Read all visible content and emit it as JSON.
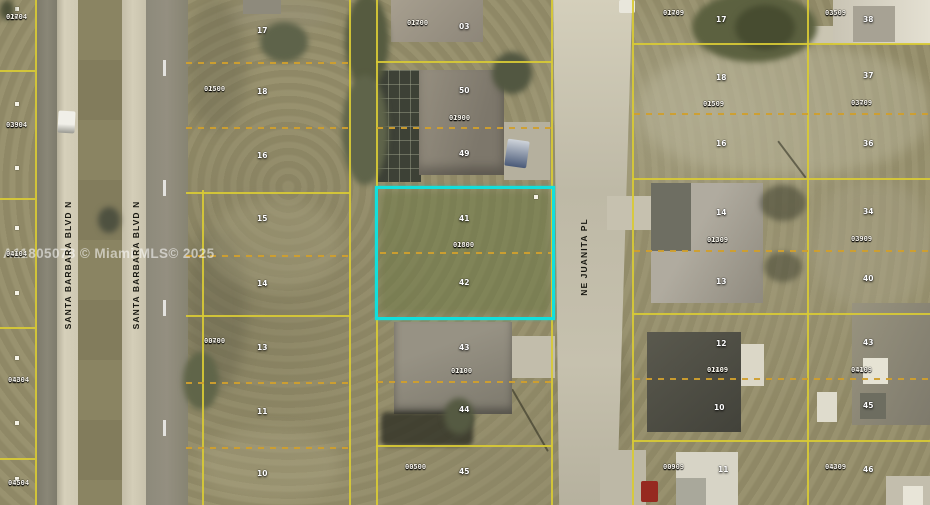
{
  "watermark_text": "A11805078 © Miami MLS© 2025",
  "streets": {
    "santa_barbara": "SANTA BARBARA BLVD N",
    "juanita": "NE JUANITA PL"
  },
  "highlighted_lot": {
    "parcel_label": "02490 0180",
    "lot_numbers_inside": [
      "41",
      "42"
    ],
    "border_color": "#12dfdc"
  },
  "colors": {
    "boundary_solid_yellow": "#d8ca35",
    "boundary_dashed_orange": "#cf9f2e",
    "highlight_cyan": "#12dfdc"
  },
  "parcel_labels": [
    {
      "block": "02694",
      "lot": "0170",
      "x": 6,
      "y": 14
    },
    {
      "block": "02694",
      "lot": "0390",
      "x": 6,
      "y": 122
    },
    {
      "block": "02694",
      "lot": "0410",
      "x": 6,
      "y": 251
    },
    {
      "block": "02694",
      "lot": "0430",
      "x": 8,
      "y": 377
    },
    {
      "block": "02694",
      "lot": "0450",
      "x": 8,
      "y": 480
    },
    {
      "block": "02490",
      "lot": "0150",
      "x": 204,
      "y": 86
    },
    {
      "block": "02490",
      "lot": "0070",
      "x": 204,
      "y": 338
    },
    {
      "block": "02490",
      "lot": "0170",
      "x": 407,
      "y": 20
    },
    {
      "block": "02490",
      "lot": "0190",
      "x": 449,
      "y": 115
    },
    {
      "block": "02490",
      "lot": "0180",
      "x": 453,
      "y": 242
    },
    {
      "block": "02490",
      "lot": "0110",
      "x": 451,
      "y": 368
    },
    {
      "block": "02490",
      "lot": "0050",
      "x": 405,
      "y": 464
    },
    {
      "block": "02489",
      "lot": "0170",
      "x": 663,
      "y": 10
    },
    {
      "block": "02489",
      "lot": "0150",
      "x": 703,
      "y": 101
    },
    {
      "block": "02489",
      "lot": "0130",
      "x": 707,
      "y": 237
    },
    {
      "block": "02489",
      "lot": "0110",
      "x": 707,
      "y": 367
    },
    {
      "block": "02489",
      "lot": "0090",
      "x": 663,
      "y": 464
    },
    {
      "block": "02489",
      "lot": "0350",
      "x": 825,
      "y": 10
    },
    {
      "block": "02489",
      "lot": "0370",
      "x": 851,
      "y": 100
    },
    {
      "block": "02489",
      "lot": "0390",
      "x": 851,
      "y": 236
    },
    {
      "block": "02489",
      "lot": "0410",
      "x": 851,
      "y": 367
    },
    {
      "block": "02489",
      "lot": "0430",
      "x": 825,
      "y": 464
    }
  ],
  "lot_numbers": [
    {
      "n": "17",
      "x": 257,
      "y": 26
    },
    {
      "n": "18",
      "x": 257,
      "y": 87
    },
    {
      "n": "16",
      "x": 257,
      "y": 151
    },
    {
      "n": "15",
      "x": 257,
      "y": 214
    },
    {
      "n": "14",
      "x": 257,
      "y": 279
    },
    {
      "n": "13",
      "x": 257,
      "y": 343
    },
    {
      "n": "11",
      "x": 257,
      "y": 407
    },
    {
      "n": "10",
      "x": 257,
      "y": 469
    },
    {
      "n": "03",
      "x": 459,
      "y": 22
    },
    {
      "n": "50",
      "x": 459,
      "y": 86
    },
    {
      "n": "49",
      "x": 459,
      "y": 149
    },
    {
      "n": "41",
      "x": 459,
      "y": 214
    },
    {
      "n": "42",
      "x": 459,
      "y": 278
    },
    {
      "n": "43",
      "x": 459,
      "y": 343
    },
    {
      "n": "44",
      "x": 459,
      "y": 405
    },
    {
      "n": "45",
      "x": 459,
      "y": 467
    },
    {
      "n": "17",
      "x": 716,
      "y": 15
    },
    {
      "n": "18",
      "x": 716,
      "y": 73
    },
    {
      "n": "16",
      "x": 716,
      "y": 139
    },
    {
      "n": "14",
      "x": 716,
      "y": 208
    },
    {
      "n": "13",
      "x": 716,
      "y": 277
    },
    {
      "n": "12",
      "x": 716,
      "y": 339
    },
    {
      "n": "10",
      "x": 714,
      "y": 403
    },
    {
      "n": "11",
      "x": 718,
      "y": 465
    },
    {
      "n": "38",
      "x": 863,
      "y": 15
    },
    {
      "n": "37",
      "x": 863,
      "y": 71
    },
    {
      "n": "36",
      "x": 863,
      "y": 139
    },
    {
      "n": "34",
      "x": 863,
      "y": 207
    },
    {
      "n": "40",
      "x": 863,
      "y": 274
    },
    {
      "n": "43",
      "x": 863,
      "y": 338
    },
    {
      "n": "45",
      "x": 863,
      "y": 401
    },
    {
      "n": "46",
      "x": 863,
      "y": 465
    }
  ]
}
